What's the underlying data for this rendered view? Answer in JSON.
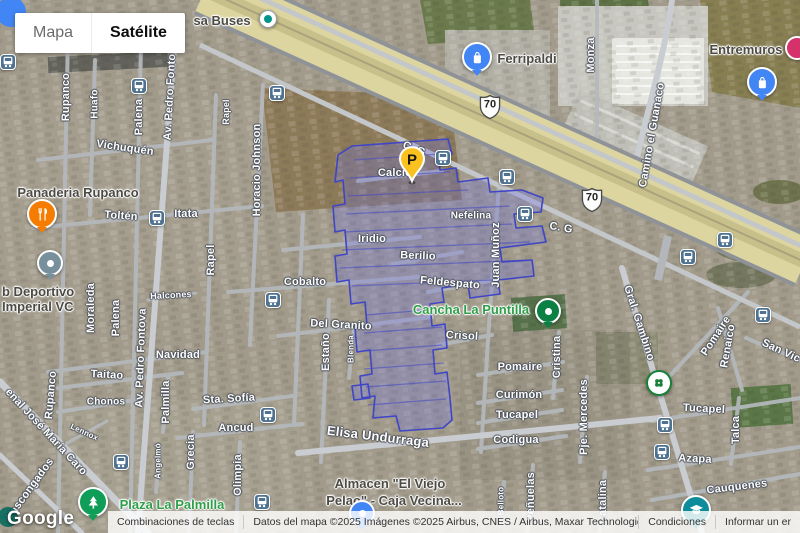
{
  "map_type_control": {
    "map": "Mapa",
    "satellite": "Satélite"
  },
  "google_logo": "Google",
  "attribution": {
    "shortcuts": "Combinaciones de teclas",
    "map_data": "Datos del mapa ©2025 Imágenes ©2025 Airbus, CNES / Airbus, Maxar Technologies",
    "terms": "Condiciones",
    "report": "Informar un er"
  },
  "colors": {
    "selection_fill": "rgba(110,114,226,0.30)",
    "selection_stroke": "#3f46c6",
    "street_text": "#ffffff",
    "poi_text": "#4c4a44",
    "park_text": "#2e9e49",
    "bus_icon_bg": "#4f7290",
    "highway": "#ddd5a0",
    "parking_pin": "#fbc21f"
  },
  "route_shields": [
    {
      "label": "70",
      "x": 490,
      "y": 107
    },
    {
      "label": "70",
      "x": 592,
      "y": 200
    }
  ],
  "street_labels": [
    {
      "t": "Vichuquén",
      "x": 125,
      "y": 148,
      "r": 8
    },
    {
      "t": "Toltén",
      "x": 121,
      "y": 216,
      "r": 4
    },
    {
      "t": "Itata",
      "x": 186,
      "y": 214,
      "r": 0
    },
    {
      "t": "Rupanco",
      "x": 66,
      "y": 97,
      "r": -90
    },
    {
      "t": "Huafo",
      "x": 95,
      "y": 104,
      "r": -90,
      "s": 10
    },
    {
      "t": "Palena",
      "x": 139,
      "y": 117,
      "r": -90
    },
    {
      "t": "Av. Pedro Fonto",
      "x": 170,
      "y": 97,
      "r": -87
    },
    {
      "t": "Horacio Johnson",
      "x": 257,
      "y": 170,
      "r": -90
    },
    {
      "t": "Rapel",
      "x": 227,
      "y": 112,
      "r": -90,
      "s": 9
    },
    {
      "t": "Rapel",
      "x": 211,
      "y": 260,
      "r": -90
    },
    {
      "t": "Moraleda",
      "x": 91,
      "y": 308,
      "r": -90
    },
    {
      "t": "Palena",
      "x": 116,
      "y": 318,
      "r": -90
    },
    {
      "t": "Av. Pedro Fontova",
      "x": 141,
      "y": 358,
      "r": -88
    },
    {
      "t": "Rupanco",
      "x": 51,
      "y": 395,
      "r": -85
    },
    {
      "t": "Navidad",
      "x": 178,
      "y": 355,
      "r": 0
    },
    {
      "t": "Taitao",
      "x": 107,
      "y": 375,
      "r": 3
    },
    {
      "t": "Chonos",
      "x": 106,
      "y": 402,
      "r": 0,
      "s": 10
    },
    {
      "t": "Halcones",
      "x": 171,
      "y": 296,
      "r": -3,
      "s": 9
    },
    {
      "t": "Lennox",
      "x": 84,
      "y": 433,
      "r": 25,
      "s": 8
    },
    {
      "t": "enal José María Caro",
      "x": 46,
      "y": 432,
      "r": 47
    },
    {
      "t": "Vascongados",
      "x": 30,
      "y": 489,
      "r": -54
    },
    {
      "t": "Sta. Sofía",
      "x": 229,
      "y": 399,
      "r": -3
    },
    {
      "t": "Ancud",
      "x": 236,
      "y": 428,
      "r": 0
    },
    {
      "t": "Grecia",
      "x": 191,
      "y": 452,
      "r": -90
    },
    {
      "t": "Olimpia",
      "x": 238,
      "y": 475,
      "r": -90
    },
    {
      "t": "Angelmó",
      "x": 159,
      "y": 461,
      "r": -90,
      "s": 8
    },
    {
      "t": "Palmilla",
      "x": 166,
      "y": 402,
      "r": -90
    },
    {
      "t": "Iridio",
      "x": 372,
      "y": 239,
      "r": 0
    },
    {
      "t": "Cobalto",
      "x": 305,
      "y": 282,
      "r": 0
    },
    {
      "t": "Del Granito",
      "x": 341,
      "y": 325,
      "r": 3
    },
    {
      "t": "Estaño",
      "x": 326,
      "y": 352,
      "r": -90
    },
    {
      "t": "Blenda",
      "x": 352,
      "y": 349,
      "r": -90,
      "s": 8
    },
    {
      "t": "Calcio",
      "x": 395,
      "y": 173,
      "r": 0
    },
    {
      "t": "Berilio",
      "x": 418,
      "y": 256,
      "r": 2
    },
    {
      "t": "Feldespato",
      "x": 450,
      "y": 283,
      "r": 5
    },
    {
      "t": "Nefelina",
      "x": 471,
      "y": 216,
      "r": 0,
      "s": 10
    },
    {
      "t": "Crisol",
      "x": 462,
      "y": 336,
      "r": 3
    },
    {
      "t": "C. G",
      "x": 414,
      "y": 149,
      "r": 22
    },
    {
      "t": "C. G",
      "x": 561,
      "y": 228,
      "r": 10
    },
    {
      "t": "Juan Muñoz",
      "x": 496,
      "y": 255,
      "r": -90
    },
    {
      "t": "Elisa Undurraga",
      "x": 378,
      "y": 437,
      "r": 7,
      "s": 13
    },
    {
      "t": "Cristina",
      "x": 557,
      "y": 357,
      "r": -90
    },
    {
      "t": "Pje. Mercedes",
      "x": 584,
      "y": 417,
      "r": -90
    },
    {
      "t": "Peñuelas",
      "x": 531,
      "y": 497,
      "r": -90
    },
    {
      "t": "Belloto",
      "x": 502,
      "y": 501,
      "r": -90,
      "s": 8
    },
    {
      "t": "Catalina",
      "x": 603,
      "y": 502,
      "r": -90
    },
    {
      "t": "Pomaire",
      "x": 520,
      "y": 367,
      "r": 0
    },
    {
      "t": "Curimón",
      "x": 519,
      "y": 395,
      "r": 0
    },
    {
      "t": "Tucapel",
      "x": 517,
      "y": 415,
      "r": 0
    },
    {
      "t": "Codigua",
      "x": 516,
      "y": 440,
      "r": 0
    },
    {
      "t": "Pomaire",
      "x": 716,
      "y": 336,
      "r": -57
    },
    {
      "t": "Renaico",
      "x": 728,
      "y": 346,
      "r": -80
    },
    {
      "t": "San Vic",
      "x": 781,
      "y": 351,
      "r": 25
    },
    {
      "t": "Gral. Gambino",
      "x": 639,
      "y": 323,
      "r": 72
    },
    {
      "t": "Tucapel",
      "x": 704,
      "y": 409,
      "r": 3
    },
    {
      "t": "Talca",
      "x": 736,
      "y": 430,
      "r": -90
    },
    {
      "t": "Azapa",
      "x": 695,
      "y": 459,
      "r": 3
    },
    {
      "t": "Cauquenes",
      "x": 737,
      "y": 487,
      "r": -7
    },
    {
      "t": "Monza",
      "x": 591,
      "y": 55,
      "r": -90
    },
    {
      "t": "Camino el Guanaco",
      "x": 652,
      "y": 135,
      "r": -80
    }
  ],
  "poi_labels": [
    {
      "t": "sa Buses",
      "x": 222,
      "y": 21,
      "s": 13
    },
    {
      "t": "Ferripaldi",
      "x": 527,
      "y": 59,
      "s": 13
    },
    {
      "t": "Entremuros",
      "x": 746,
      "y": 50,
      "s": 13
    },
    {
      "t": "Panaderia Rupanco",
      "x": 78,
      "y": 193,
      "s": 13
    },
    {
      "t": "b Deportivo",
      "x": 2,
      "y": 292,
      "s": 13,
      "align": "left"
    },
    {
      "t": "Imperial VC",
      "x": 2,
      "y": 307,
      "s": 13,
      "align": "left"
    },
    {
      "t": "Almacen \"El Viejo",
      "x": 390,
      "y": 484,
      "s": 13
    },
    {
      "t": "Pelao\" - Caja Vecina...",
      "x": 394,
      "y": 501,
      "s": 13
    }
  ],
  "park_labels": [
    {
      "t": "Cancha La Puntilla",
      "x": 471,
      "y": 310,
      "s": 13
    },
    {
      "t": "Plaza La Palmilla",
      "x": 172,
      "y": 505,
      "s": 13
    }
  ],
  "markers": [
    {
      "type": "parking",
      "color": "#fbc21f",
      "x": 412,
      "y": 164
    },
    {
      "type": "dot",
      "color": "#0b8043",
      "x": 548,
      "y": 311
    },
    {
      "type": "tree",
      "color": "#0f9d58",
      "x": 93,
      "y": 502
    },
    {
      "type": "restaurant",
      "color": "#f57c00",
      "x": 42,
      "y": 214
    },
    {
      "type": "dot",
      "color": "#78909c",
      "x": 50,
      "y": 263
    },
    {
      "type": "bag",
      "color": "#4285f4",
      "x": 477,
      "y": 57
    },
    {
      "type": "smalldot",
      "color": "#009688",
      "x": 268,
      "y": 19
    },
    {
      "type": "plain",
      "color": "#d5326b",
      "x": 797,
      "y": 48
    },
    {
      "type": "clover",
      "color": "#188038",
      "x": 659,
      "y": 383
    },
    {
      "type": "cap",
      "color": "#0e8c9c",
      "x": 696,
      "y": 510
    },
    {
      "type": "bag",
      "color": "#4285f4",
      "x": 762,
      "y": 82
    },
    {
      "type": "dot",
      "color": "#4285f4",
      "x": 362,
      "y": 513
    }
  ],
  "bus_stops": [
    [
      8,
      62
    ],
    [
      139,
      86
    ],
    [
      277,
      93
    ],
    [
      443,
      158
    ],
    [
      507,
      177
    ],
    [
      525,
      214
    ],
    [
      688,
      257
    ],
    [
      725,
      240
    ],
    [
      763,
      315
    ],
    [
      157,
      218
    ],
    [
      273,
      300
    ],
    [
      268,
      415
    ],
    [
      121,
      462
    ],
    [
      262,
      502
    ],
    [
      665,
      425
    ],
    [
      662,
      452
    ]
  ]
}
